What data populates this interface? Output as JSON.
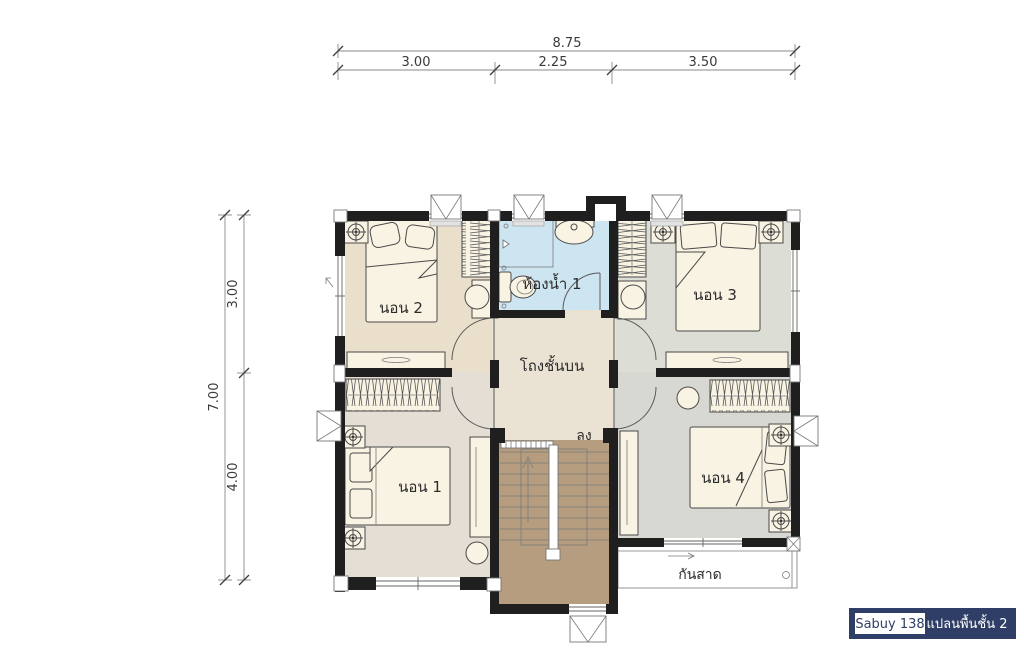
{
  "badge": {
    "model": "Sabuy 138",
    "plan": "แปลนพื้นชั้น 2"
  },
  "dimensions": {
    "top_total": "8.75",
    "top_segments": [
      "3.00",
      "2.25",
      "3.50"
    ],
    "left_total": "7.00",
    "left_segments": [
      "3.00",
      "4.00"
    ]
  },
  "rooms": {
    "bedroom2": "นอน 2",
    "bathroom1": "ห้องน้ำ 1",
    "bedroom3": "นอน 3",
    "hall": "โถงชั้นบน",
    "bedroom1": "นอน 1",
    "bedroom4": "นอน 4"
  },
  "annotations": {
    "stairs_down": "ลง",
    "awning": "กันสาด"
  },
  "colors": {
    "wall": "#1f1f1f",
    "floor_bedroom1": "#e4ded4",
    "floor_bedroom2": "#eadfcb",
    "floor_bedroom3": "#dcded5",
    "floor_bedroom4": "#d6d8d1",
    "floor_bathroom": "#cde4f1",
    "floor_hall": "#eae2d3",
    "floor_stairs": "#b69d7f",
    "furniture": "#f8f3e3",
    "badge_navy": "#2f3e66",
    "text": "#2b2b2b",
    "dim": "#3a3a3a"
  }
}
